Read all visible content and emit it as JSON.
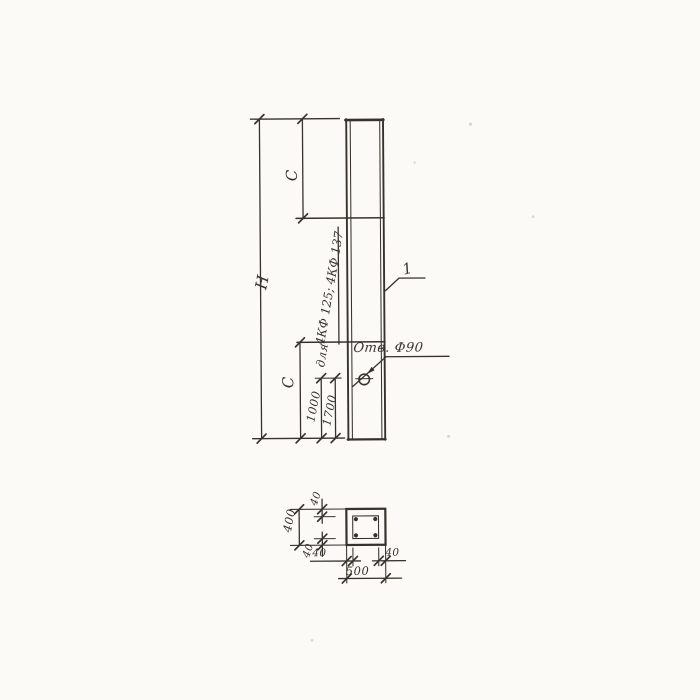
{
  "colors": {
    "paper": "#fbfaf7",
    "ink": "#37332c"
  },
  "elevation": {
    "height_label": "H",
    "c_top": "C",
    "c_bottom": "C",
    "hole_offset_a": "1000",
    "hole_offset_b": "1700",
    "note_prefix": "для",
    "note_series": "4КФ 125; 4КФ 137",
    "hole_callout": "Отв. Ф90",
    "part_mark": "1"
  },
  "section": {
    "width": "500",
    "height": "400",
    "cover_top": "40",
    "cover_bottom": "40",
    "cover_left": "40",
    "cover_right": "40"
  }
}
